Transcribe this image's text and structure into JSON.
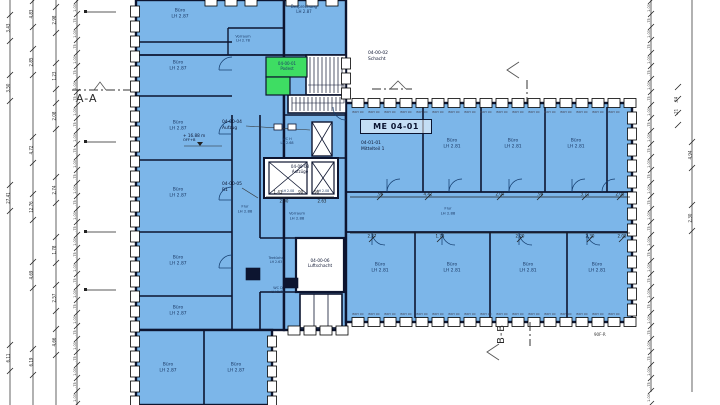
{
  "colors": {
    "room": "#7cb6e9",
    "green": "#3edd63",
    "wall": "#0d1530",
    "white": "#ffffff",
    "dim_text": "#1b1b1b",
    "label_text": "#1c3a66"
  },
  "sections": {
    "aa": "A-A",
    "bb": "B-B"
  },
  "ids": {
    "podest_id": "04-00-01",
    "podest_name": "Podest",
    "schacht_id": "04-00-02",
    "schacht_name": "Schacht",
    "aufzuege_id": "04-00-03",
    "aufzuege_name": "Aufzüge",
    "aufzug_id": "04-00-04",
    "aufzug_name": "Aufzug",
    "r1_id": "04-00-05",
    "r1_name": "R1",
    "luft_id": "04-00-06",
    "luft_name": "Luftschacht",
    "me_box": "ME 04-01",
    "mittelteil_id": "04-01-01",
    "mittelteil_name": "Mittelteil 1"
  },
  "rooms": {
    "buero87": {
      "name": "Büro",
      "lh": "LH 2.87"
    },
    "buero81": {
      "name": "Büro",
      "lh": "LH 2.81"
    },
    "besprechung": {
      "name": "Besprechung",
      "lh": "LH 2.87"
    },
    "vorraum278": {
      "name": "Vorraum",
      "lh": "LH 2.78"
    },
    "vorraum288": {
      "name": "Vorraum",
      "lh": "LH 2.88"
    },
    "flur": {
      "name": "Flur",
      "lh": "LH 2.88"
    },
    "wch": {
      "name": "WC H",
      "lh": "LH 2.68"
    },
    "wcd": {
      "name": "WC D",
      "lh": "LH 2.78"
    },
    "teekueche": {
      "name": "Teeküche",
      "lh": "LH 2.63"
    },
    "lift_lh": "LH 2.08"
  },
  "markers": {
    "elevation_value": "+ 16.88 m",
    "elevation_ref": "OFF+B",
    "sheet_note": "90F-R",
    "window_label": "BRH 90"
  },
  "dims": {
    "left_col1": [
      "3.43",
      "3.50",
      "27.41",
      "6.11"
    ],
    "left_col2": [
      "4.83",
      "2.85",
      "4.72",
      "12.76",
      "4.69",
      "6.19"
    ],
    "left_col3": [
      "2.98",
      "1.23",
      "2.08",
      "2.74",
      "1.78",
      "2.57",
      "4.66"
    ],
    "module_a": "1.00",
    "module_b": ".75",
    "right_col": [
      "4.94",
      "2.30"
    ],
    "right_col2": [
      ".24",
      ".21"
    ],
    "corridor_top": [
      ".96",
      "4.42",
      "2.04",
      ".98",
      "3.71",
      "2.08"
    ],
    "corridor_bottom": [
      "2.27",
      "1.73",
      "2.20",
      "2.30",
      "2.08"
    ],
    "core_chain": [
      "1.43",
      ".90",
      ".90",
      "2.00",
      "2.63"
    ]
  }
}
